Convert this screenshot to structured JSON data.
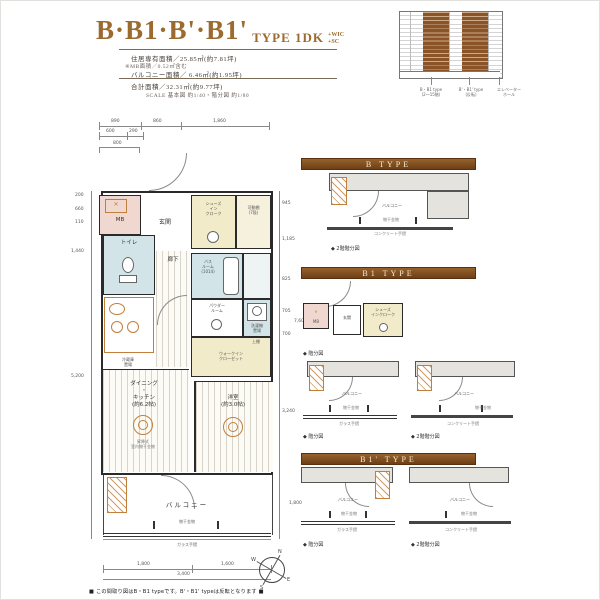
{
  "header": {
    "title_main": "B·B1·B'·B1'",
    "title_type": "TYPE 1DK",
    "tag1": "+WIC",
    "tag2": "+SC",
    "spec1": "住居専有面積／25.85㎡(約7.81坪)",
    "spec2": "※MB面積／0.52㎡含む",
    "spec3": "バルコニー面積／ 6.46㎡(約1.95坪)",
    "spec4": "合計面積／32.31㎡(約9.77坪)",
    "scale": "SCALE 基本図 約1/40・階分図 約1/80"
  },
  "locator": {
    "captions": [
      "B・B1 type\n(2〜15階)",
      "B'・B1' type\n(反転)",
      "エレベーター\nホール"
    ]
  },
  "plan": {
    "dims": {
      "top1": [
        "890",
        "860",
        "1,860"
      ],
      "top2": [
        "600",
        "290"
      ],
      "top3": "800",
      "left": [
        "200",
        "660",
        "110",
        "1,440",
        "5,200"
      ],
      "right": [
        "945",
        "1,185",
        "825",
        "705",
        "700",
        "3,240"
      ],
      "right_total": "7,600",
      "balcony_side": "1,800",
      "bottom": [
        "1,800",
        "1,600"
      ],
      "bottom_total": "3,400"
    },
    "rooms": {
      "mb": "MB",
      "genkan": "玄関",
      "sic": "シューズ\nイン\nクローク",
      "shelf": "可動棚\n(7段)",
      "toilet": "トイレ",
      "hall": "廊下",
      "bath": "バス\nルーム\n(1014)",
      "powder": "パウダー\nルーム",
      "laundry": "洗濯機\n置場",
      "pan": "防水パン",
      "uedana": "上棚",
      "wic": "ウォークイン\nクローゼット",
      "sagari": "下り天井",
      "fridge": "冷蔵庫\n置場",
      "dk": "ダイニング\n・\nキッチン\n(約6.2帖)",
      "bedroom": "洋室\n(約3.0帖)",
      "hoshi": "昇降式\n室内物干金物",
      "balcony": "バルコニー",
      "monohoshi": "物干金物",
      "glass_rail": "ガラス手摺"
    }
  },
  "sections": [
    {
      "label": "B TYPE",
      "caption_right": "◆ 2階階分図"
    },
    {
      "label": "B1 TYPE",
      "caption_entrance": "◆ 階分図",
      "caption_left": "◆ 階分図",
      "caption_right": "◆ 2階階分図"
    },
    {
      "label": "B1' TYPE",
      "caption_left": "◆ 階分図",
      "caption_right": "◆ 2階階分図"
    }
  ],
  "mini": {
    "balcony": "バルコニー",
    "monohoshi": "物干金物",
    "glass_rail": "ガラス手摺",
    "concrete_rail": "コンクリート手摺",
    "mb": "MB",
    "genkan": "玄関",
    "sic": "シューズ\nインクローク"
  },
  "compass": {
    "n": "N",
    "e": "E",
    "s": "S",
    "w": "W"
  },
  "footer": {
    "note": "■ この間取り図はB・B1 typeです。B'・B1' typeは反転となります ■"
  }
}
